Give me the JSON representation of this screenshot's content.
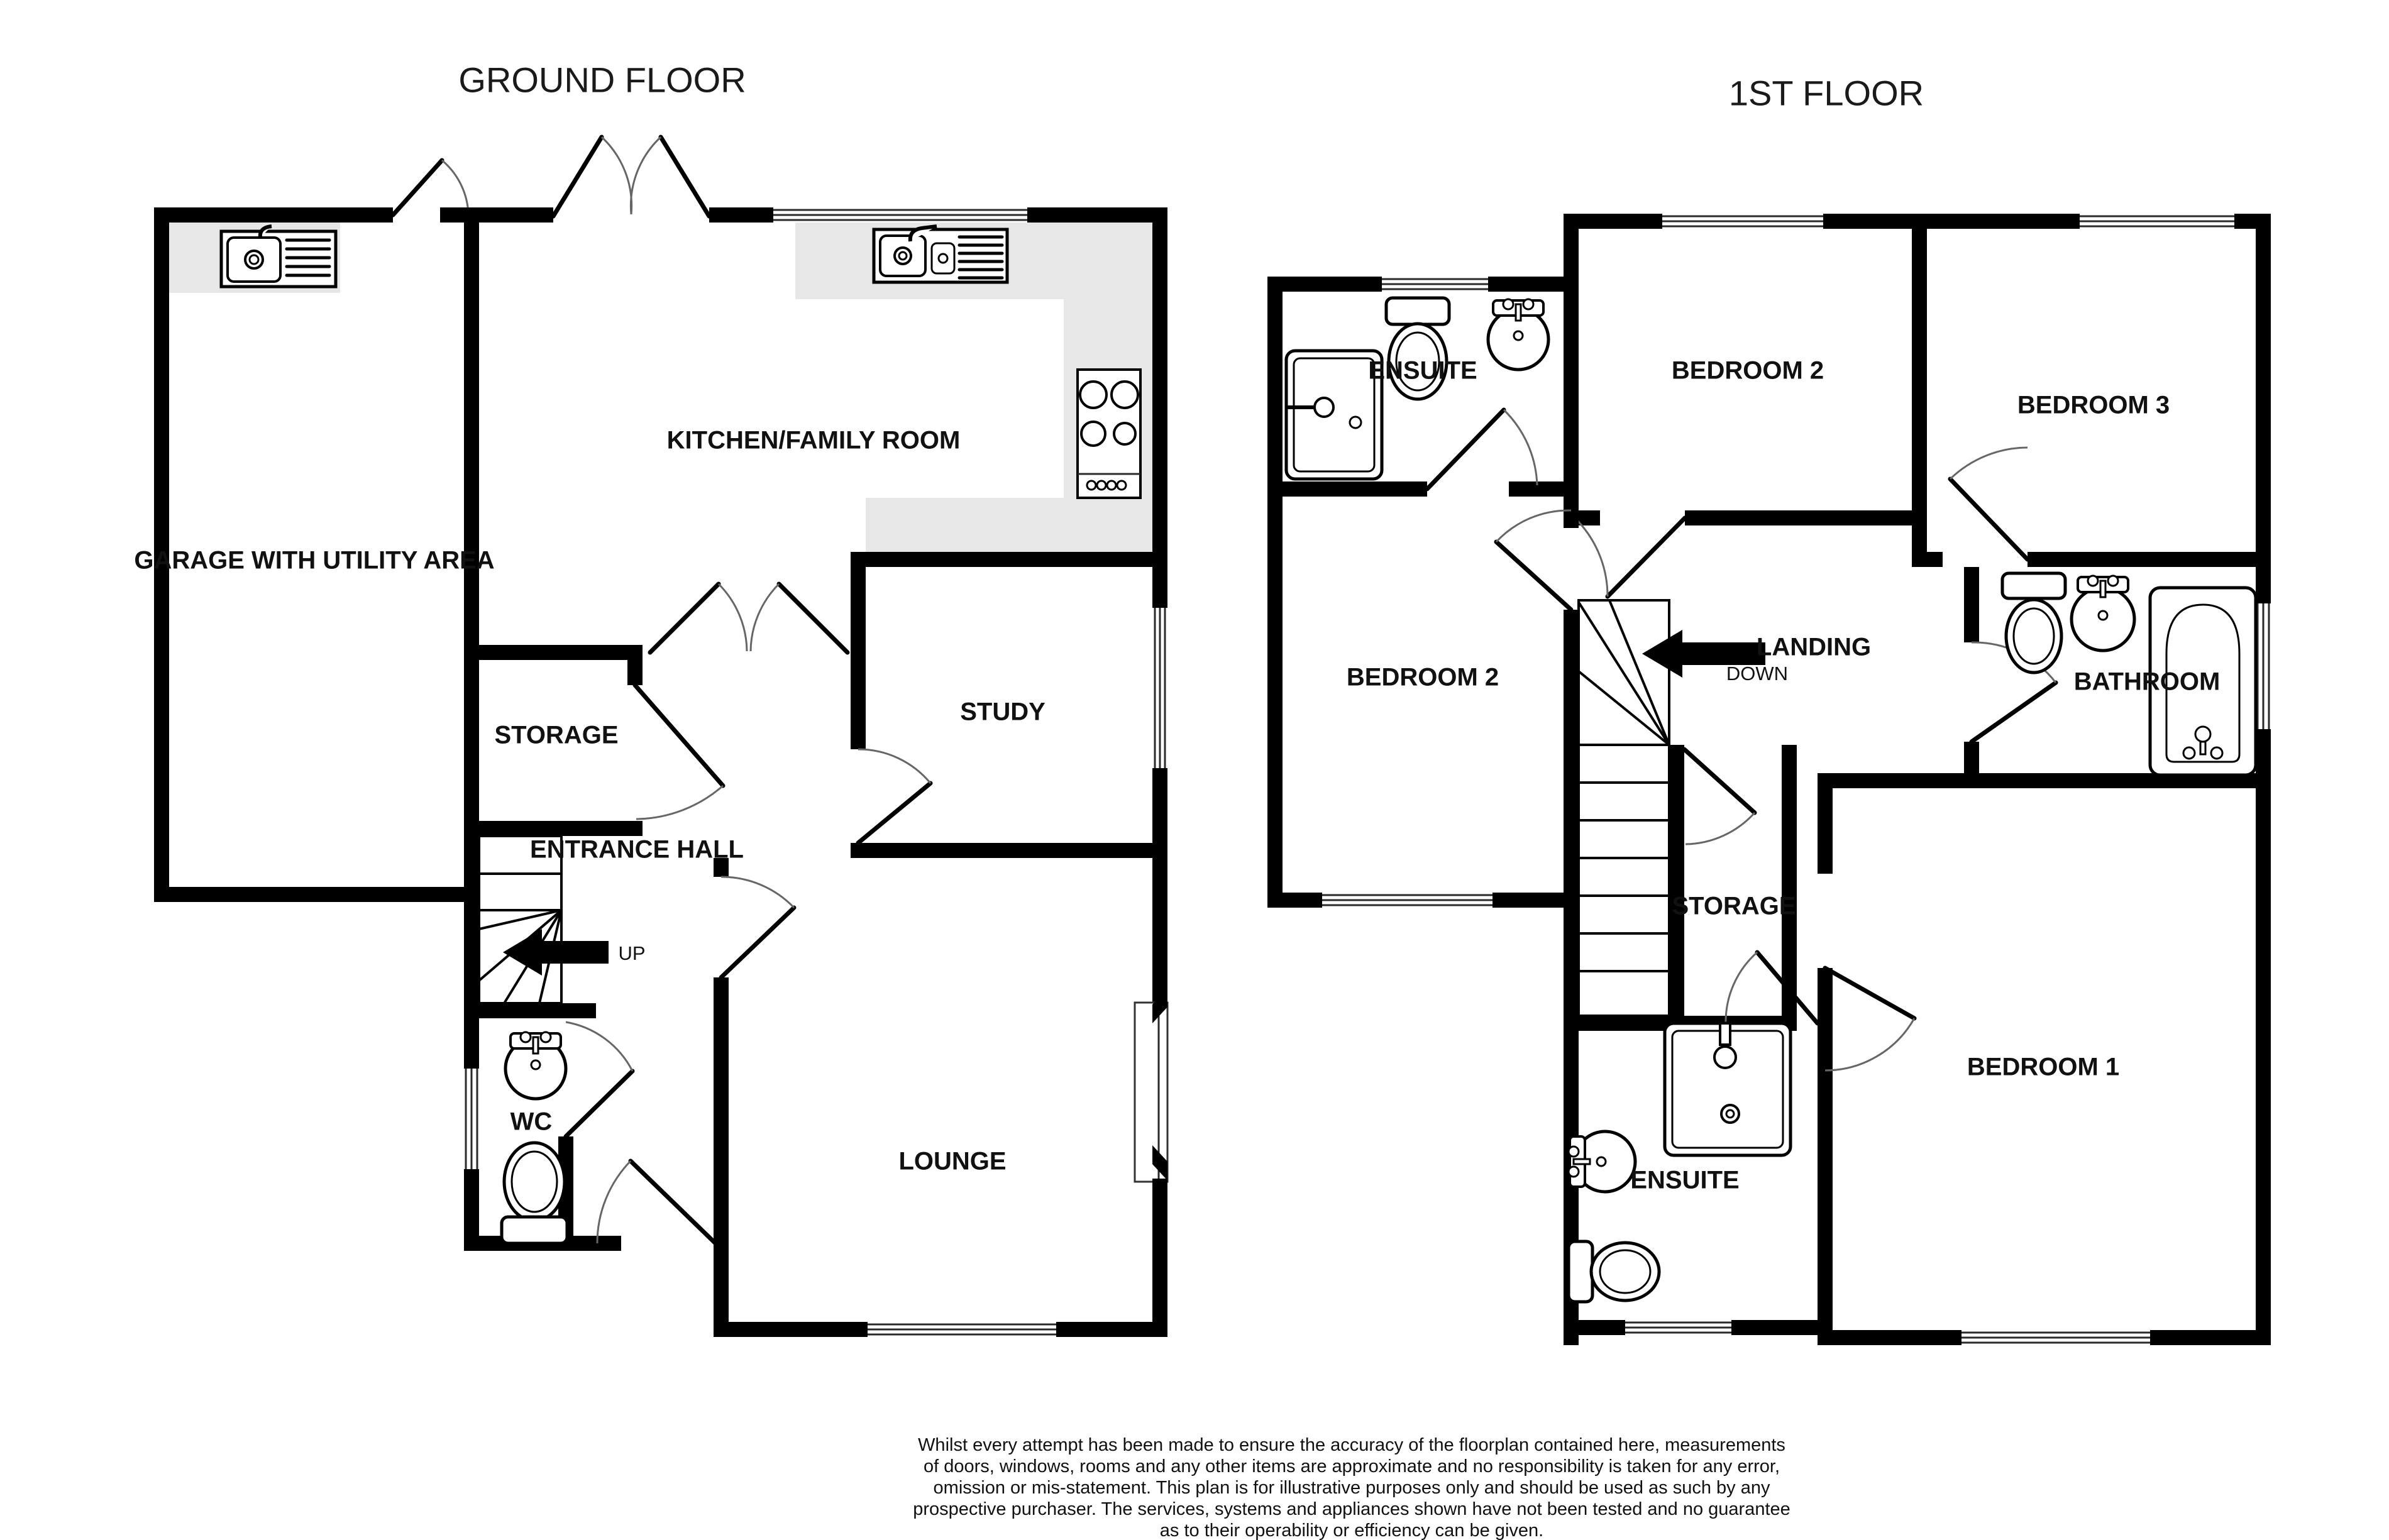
{
  "ground_floor": {
    "title": "GROUND FLOOR",
    "rooms": {
      "kitchen": "KITCHEN/FAMILY ROOM",
      "garage": "GARAGE WITH UTILITY AREA",
      "storage": "STORAGE",
      "study": "STUDY",
      "entrance_hall": "ENTRANCE HALL",
      "wc": "WC",
      "lounge": "LOUNGE"
    },
    "stair_direction_label": "UP"
  },
  "first_floor": {
    "title": "1ST FLOOR",
    "rooms": {
      "ensuite_top": "ENSUITE",
      "bedroom2_top": "BEDROOM 2",
      "bedroom3": "BEDROOM 3",
      "bedroom2_left": "BEDROOM 2",
      "landing": "LANDING",
      "bathroom": "BATHROOM",
      "storage": "STORAGE",
      "ensuite_bottom": "ENSUITE",
      "bedroom1": "BEDROOM 1"
    },
    "stair_direction_label": "DOWN"
  },
  "footer": {
    "disclaimer_lines": [
      "Whilst every attempt has been made to ensure the accuracy of the floorplan contained here, measurements",
      "of doors, windows, rooms and any other items are approximate and no responsibility is taken for any error,",
      "omission or mis-statement. This plan is for illustrative purposes only and should be used as such by any",
      "prospective purchaser. The services, systems and appliances shown have not been tested and no guarantee",
      "as to their operability or efficiency can be given."
    ],
    "credit": "Made with Metropix ©2026"
  },
  "colors": {
    "wall": "#000000",
    "counter": "#e7e7e7",
    "door_arc": "#666666",
    "background": "#ffffff",
    "text": "#111111"
  }
}
